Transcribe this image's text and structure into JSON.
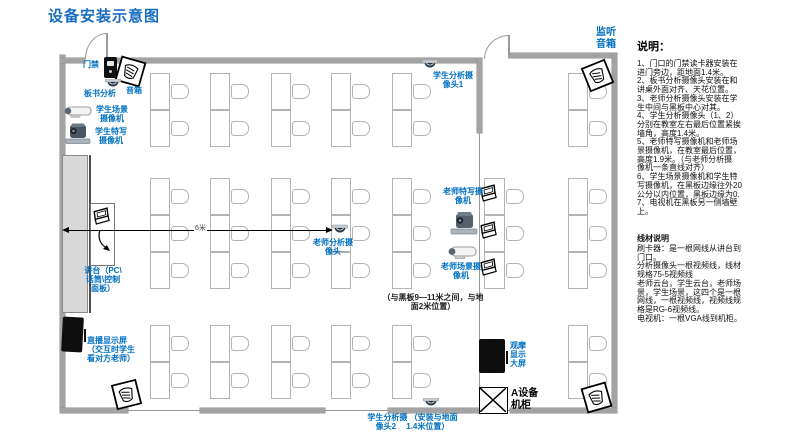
{
  "title": "设备安装示意图",
  "colors": {
    "title_blue": "#1a6dc0",
    "label_blue": "#0070c0",
    "wall_gray": "#a3a3a3",
    "desk_border": "#b3b3b3",
    "screen_black": "#0e0e0e"
  },
  "labels": {
    "door_access": "门禁",
    "speaker": "音箱",
    "board_analysis": "板书分析",
    "student_scene_cam": "学生场景\n摄像机",
    "student_closeup_cam": "学生特写\n摄像机",
    "podium": "讲台（PC\\\n话筒\\控制\n面板）",
    "live_display": "直播显示屏\n（交互时学生\n看对方老师）",
    "distance": "6米",
    "teacher_analysis_cam": "老师分析摄\n像头",
    "student_analysis_cam1": "学生分析摄\n像头1",
    "student_analysis_cam2": "学生分析摄 （安装与地面\n像头2　 1.4米位置）",
    "teacher_closeup_cam": "老师特写摄\n像机",
    "teacher_scene_cam": "老师场景摄\n像机",
    "rear_note": "（与黑板9—11米之间，与地\n面2米位置）",
    "monitor_speaker": "监听\n音箱",
    "observe_display": "观摩\n显示\n大屏",
    "cabinet": "A设备\n机柜"
  },
  "notes": {
    "heading": "说明：",
    "body": "1、门口的门禁读卡器安装在\n进门旁边，距地面1.4米。\n2、板书分析摄像头安装在和\n讲桌外面对齐、天花位置。\n3、老师分析摄像头安装在学\n生中间与黑板中心对其。\n4、学生分析摄像头（1、2）\n分别在教室左右最后位置紧挨\n墙角，高度1.4米。\n5、老师特写摄像机和老师场\n景摄像机，在教室最后位置，\n高度1.9米。（与老师分析摄\n像机一条直线对齐）\n6、学生场景摄像机和学生特\n写摄像机，在黑板边缘往外20\n公分以内位置，黑板边缘为0.\n7、电视机在黑板另一侧墙壁\n上。",
    "cable_heading": "线材说明",
    "cable_body": "刷卡器：是一根网线从讲台到\n门口。\n分析摄像头一根视频线，线材\n规格75-5视频线\n老师云台，学生云台，老师场\n景，学生场景，这四个是一根\n网线，一根视频线，视频线规\n格是RG-6视频线。\n电视机：一根VGA线到机柜。"
  },
  "floorplan": {
    "main_columns_x": [
      150,
      210,
      271,
      331,
      392
    ],
    "right_column_x": 568,
    "groups": [
      {
        "y": 73,
        "count": 2
      },
      {
        "y": 178,
        "count": 3
      },
      {
        "y": 325,
        "count": 2
      }
    ],
    "desk": {
      "w": 20,
      "h": 37
    },
    "chair": {
      "dx": 21,
      "dy": 11,
      "w": 18,
      "h": 15
    },
    "laptop_column": {
      "x": 484,
      "y": 178,
      "count": 3,
      "desk_w": 21
    }
  }
}
